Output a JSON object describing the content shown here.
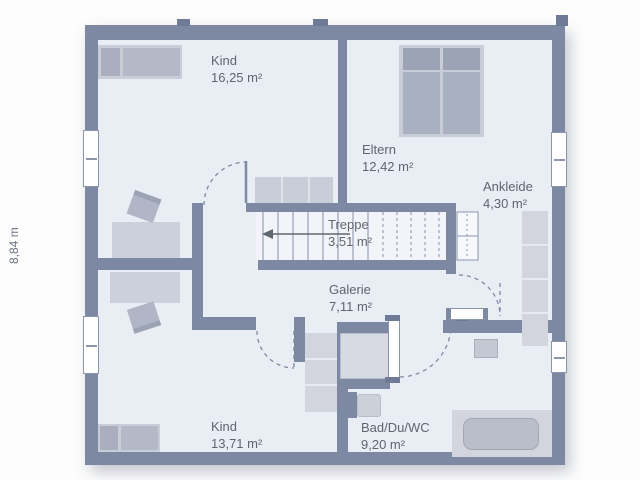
{
  "plan": {
    "title": "Obergeschoss Grundriss",
    "dimension_label": "8,84 m",
    "rooms": [
      {
        "id": "kind_top",
        "name": "Kind",
        "area": "16,25 m²"
      },
      {
        "id": "eltern",
        "name": "Eltern",
        "area": "12,42 m²"
      },
      {
        "id": "ankleide",
        "name": "Ankleide",
        "area": "4,30 m²"
      },
      {
        "id": "treppe",
        "name": "Treppe",
        "area": "3,51 m²"
      },
      {
        "id": "galerie",
        "name": "Galerie",
        "area": "7,11 m²"
      },
      {
        "id": "kind_bottom",
        "name": "Kind",
        "area": "13,71 m²"
      },
      {
        "id": "bad",
        "name": "Bad/Du/WC",
        "area": "9,20 m²"
      }
    ],
    "colors": {
      "wall": "#7d89a3",
      "floor": "#e9edf4",
      "stair_floor": "#f2f4f9",
      "furniture_light": "#d2d5de",
      "furniture_mid": "#b5bac8",
      "furniture_dark": "#9ba3b4",
      "text": "#5e6671",
      "background": "#ffffff"
    }
  }
}
